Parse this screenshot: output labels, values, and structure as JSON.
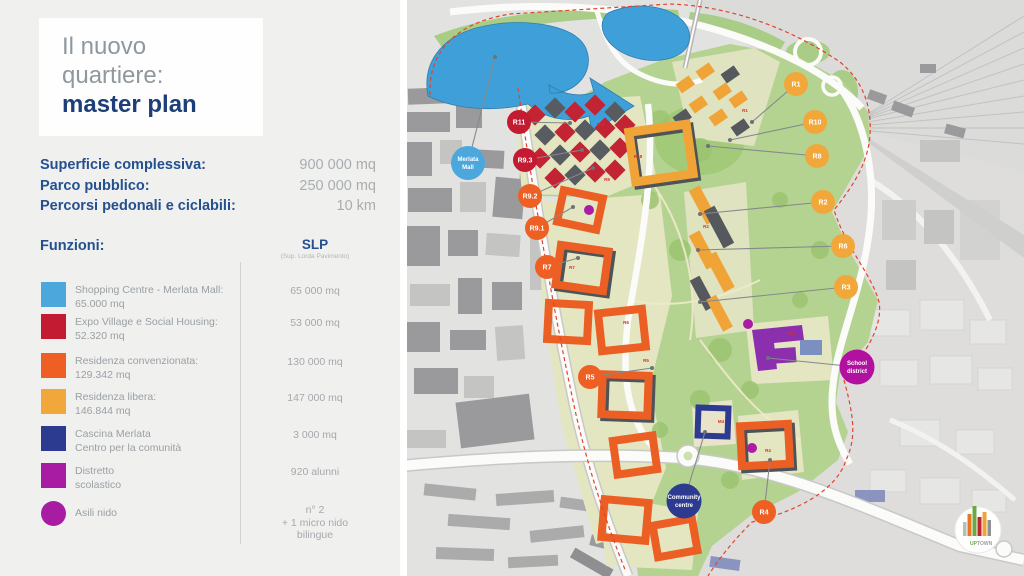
{
  "panel": {
    "title": {
      "line1": "Il nuovo",
      "line2": "quartiere:",
      "line3": "master plan"
    },
    "stats": [
      {
        "label": "Superficie complessiva:",
        "value": "900 000 mq"
      },
      {
        "label": "Parco pubblico:",
        "value": "250 000 mq"
      },
      {
        "label": "Percorsi pedonali e ciclabili:",
        "value": "10 km"
      }
    ],
    "functions_header": "Funzioni:",
    "slp": {
      "header": "SLP",
      "subheader": "(Sup. Lorda Pavimento)"
    },
    "legend": [
      {
        "shape": "square",
        "color": "#4BA7DC",
        "line1": "Shopping Centre - Merlata Mall:",
        "line2": "65.000 mq",
        "value1": "65 000 mq",
        "value2": "",
        "value3": ""
      },
      {
        "shape": "square",
        "color": "#C21B32",
        "line1": "Expo Village e Social Housing:",
        "line2": "52.320 mq",
        "value1": "53 000 mq",
        "value2": "",
        "value3": ""
      },
      {
        "shape": "square",
        "color": "#EE5F24",
        "line1": "Residenza convenzionata:",
        "line2": "129.342 mq",
        "value1": "130 000 mq",
        "value2": "",
        "value3": ""
      },
      {
        "shape": "square",
        "color": "#F2A73B",
        "line1": "Residenza libera:",
        "line2": "146.844 mq",
        "value1": "147 000 mq",
        "value2": "",
        "value3": ""
      },
      {
        "shape": "square",
        "color": "#2C3A90",
        "line1": "Cascina Merlata",
        "line2": "Centro per la comunità",
        "value1": "3 000 mq",
        "value2": "",
        "value3": ""
      },
      {
        "shape": "square",
        "color": "#A81CA4",
        "line1": "Distretto",
        "line2": "scolastico",
        "value1": "920 alunni",
        "value2": "",
        "value3": ""
      },
      {
        "shape": "circle",
        "color": "#A81CA4",
        "line1": "Asili nido",
        "line2": "",
        "value1": "n° 2",
        "value2": "+ 1 micro nido",
        "value3": "bilingue"
      }
    ]
  },
  "map": {
    "markers": [
      {
        "id": "merlata-mall",
        "label": "Merlata",
        "label2": "Mall",
        "color": "#4BA7DC"
      },
      {
        "id": "r11",
        "label": "R11",
        "color": "#C21B32"
      },
      {
        "id": "r9-3",
        "label": "R9.3",
        "color": "#C21B32"
      },
      {
        "id": "r9-2",
        "label": "R9.2",
        "color": "#EE5F24"
      },
      {
        "id": "r9-1",
        "label": "R9.1",
        "color": "#EE5F24"
      },
      {
        "id": "r7",
        "label": "R7",
        "color": "#EE5F24"
      },
      {
        "id": "r5",
        "label": "R5",
        "color": "#EE5F24"
      },
      {
        "id": "community-centre",
        "label": "Community",
        "label2": "centre",
        "color": "#2C3A90"
      },
      {
        "id": "r4",
        "label": "R4",
        "color": "#EE5F24"
      },
      {
        "id": "school-district",
        "label": "School",
        "label2": "district",
        "color": "#B211A0"
      },
      {
        "id": "r3",
        "label": "R3",
        "color": "#F2A73B"
      },
      {
        "id": "r6",
        "label": "R6",
        "color": "#F2A73B"
      },
      {
        "id": "r2",
        "label": "R2",
        "color": "#F2A73B"
      },
      {
        "id": "r8",
        "label": "R8",
        "color": "#F2A73B"
      },
      {
        "id": "r10",
        "label": "R10",
        "color": "#F2A73B"
      },
      {
        "id": "r1",
        "label": "R1",
        "color": "#F2A73B"
      }
    ],
    "building_labels": [
      "R11",
      "R9",
      "R18",
      "R1",
      "R2",
      "R6",
      "R7",
      "R5",
      "R4",
      "M4",
      "PS6"
    ],
    "logo": {
      "up": "UP",
      "town": "TOWN"
    }
  }
}
